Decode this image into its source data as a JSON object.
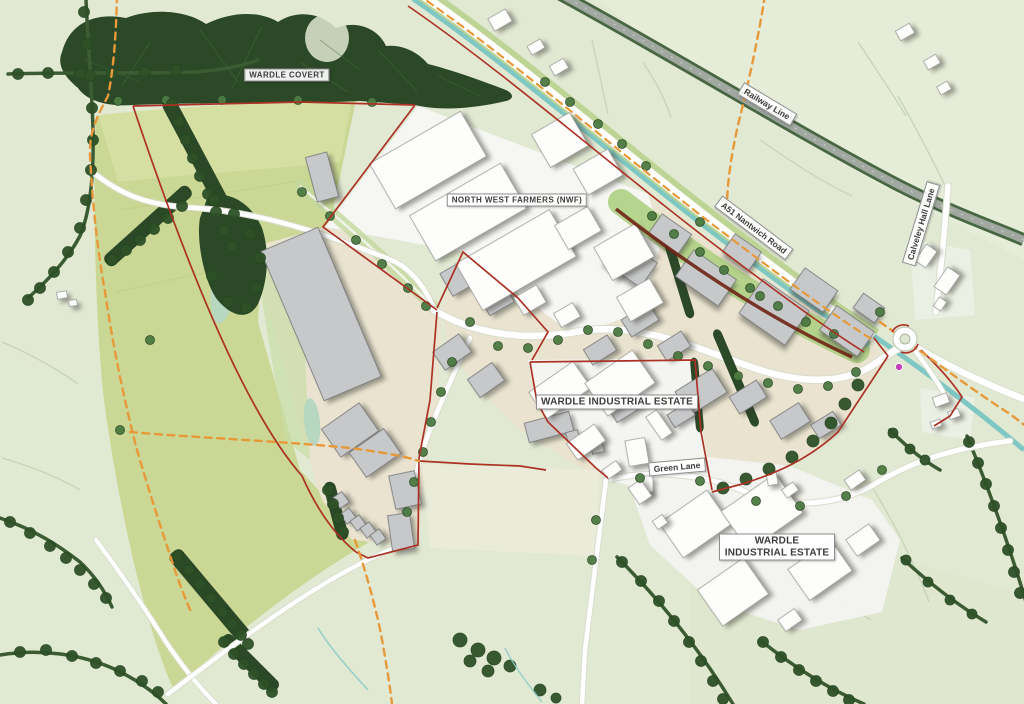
{
  "map": {
    "title": "Wardle employment masterplan",
    "labels": [
      {
        "id": "wardle-covert",
        "text": "WARDLE COVERT",
        "x": 287,
        "y": 75,
        "rot": 0,
        "style": "caps"
      },
      {
        "id": "north-west-farmers",
        "text": "NORTH WEST FARMERS (NWF)",
        "x": 517,
        "y": 200,
        "rot": 0,
        "style": "caps"
      },
      {
        "id": "railway-line",
        "text": "Railway Line",
        "x": 767,
        "y": 104,
        "rot": 31,
        "style": "plain"
      },
      {
        "id": "a51-nantwich-road",
        "text": "A51 Nantwich Road",
        "x": 754,
        "y": 228,
        "rot": 37,
        "style": "plain"
      },
      {
        "id": "calveley-hall-lane",
        "text": "Calveley Hall Lane",
        "x": 921,
        "y": 224,
        "rot": -73,
        "style": "plain"
      },
      {
        "id": "wardle-industrial-estate-north",
        "text": "WARDLE INDUSTRIAL ESTATE",
        "x": 617,
        "y": 402,
        "rot": 0,
        "style": "caps-lg"
      },
      {
        "id": "green-lane",
        "text": "Green Lane",
        "x": 677,
        "y": 467,
        "rot": -5,
        "style": "plain"
      },
      {
        "id": "wardle-industrial-estate-south",
        "text": "WARDLE INDUSTRIAL ESTATE",
        "x": 777,
        "y": 547,
        "rot": 0,
        "style": "caps-lg two-line"
      }
    ],
    "colors": {
      "background": "#e2e9d3",
      "field_yellow": "#cbd794",
      "field_yellow_light": "#d7e0a3",
      "woodland": "#2b4827",
      "tree": "#4d7a42",
      "tree_dark": "#2e5128",
      "verge": "#b6d089",
      "platform_beige": "#e9e3cf",
      "building_gray": "#c7c8c9",
      "building_white": "#fdfdfc",
      "road_white": "#ffffff",
      "railway_gray": "#a0a8a0",
      "railway_edge": "#3c5a36",
      "canal_teal": "#7fc7c3",
      "boundary_red": "#ab3225",
      "boundary_dark": "#6e2415",
      "footpath_orange": "#e7993a",
      "marker_magenta": "#c33fbe",
      "label_text": "#3c3c3c"
    }
  }
}
